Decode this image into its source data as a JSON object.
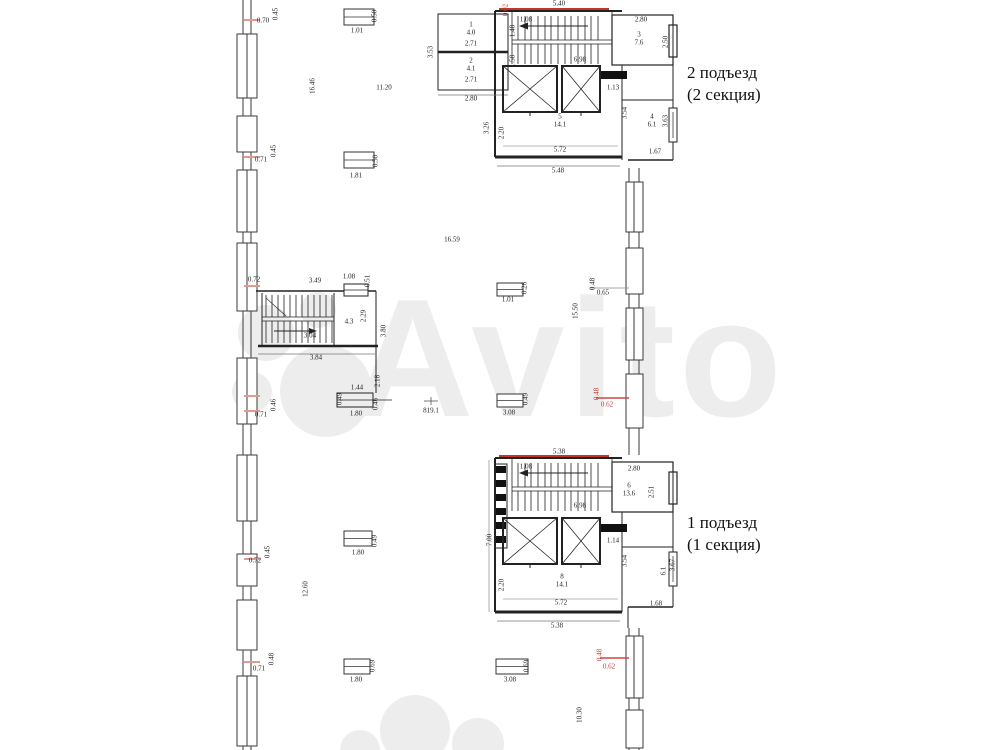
{
  "watermark": {
    "brand": "Avito"
  },
  "annotations": {
    "entrance2_line1": "2 подъезд",
    "entrance2_line2": "(2 секция)",
    "entrance1_line1": "1 подъезд",
    "entrance1_line2": "(1 секция)"
  },
  "plan": {
    "type": "floor-plan",
    "units": "meters",
    "large_area_label": "819.1",
    "labels": [
      {
        "t": "0.70",
        "x": 263,
        "y": 21
      },
      {
        "t": "0.45",
        "x": 276,
        "y": 14,
        "r": -90
      },
      {
        "t": "1.01",
        "x": 357,
        "y": 31
      },
      {
        "t": "0.50",
        "x": 375,
        "y": 16,
        "r": -90
      },
      {
        "t": "16.46",
        "x": 313,
        "y": 86,
        "r": -90
      },
      {
        "t": "11.20",
        "x": 384,
        "y": 88
      },
      {
        "t": "0.71",
        "x": 261,
        "y": 160
      },
      {
        "t": "0.45",
        "x": 274,
        "y": 151,
        "r": -90
      },
      {
        "t": "1.81",
        "x": 356,
        "y": 176
      },
      {
        "t": "0.50",
        "x": 376,
        "y": 161,
        "r": -90
      },
      {
        "t": "5.40",
        "x": 559,
        "y": 4
      },
      {
        "t": "0.02",
        "x": 506,
        "y": 10,
        "r": -90,
        "c": "red"
      },
      {
        "t": "1",
        "x": 471,
        "y": 25
      },
      {
        "t": "4.0",
        "x": 471,
        "y": 33
      },
      {
        "t": "2.71",
        "x": 471,
        "y": 44
      },
      {
        "t": "3.53",
        "x": 431,
        "y": 52,
        "r": -90
      },
      {
        "t": "1.48",
        "x": 513,
        "y": 31,
        "r": -90
      },
      {
        "t": "2",
        "x": 471,
        "y": 61
      },
      {
        "t": "4.1",
        "x": 471,
        "y": 69
      },
      {
        "t": "2.71",
        "x": 471,
        "y": 80
      },
      {
        "t": "1.58",
        "x": 513,
        "y": 61,
        "r": -90
      },
      {
        "t": "2.80",
        "x": 471,
        "y": 99
      },
      {
        "t": "1.08",
        "x": 526,
        "y": 20
      },
      {
        "t": "6.98",
        "x": 580,
        "y": 60
      },
      {
        "t": "2.80",
        "x": 641,
        "y": 20
      },
      {
        "t": "3",
        "x": 639,
        "y": 35
      },
      {
        "t": "7.6",
        "x": 639,
        "y": 43
      },
      {
        "t": "2.50",
        "x": 666,
        "y": 42,
        "r": -90
      },
      {
        "t": "1.13",
        "x": 613,
        "y": 88
      },
      {
        "t": "3.26",
        "x": 487,
        "y": 128,
        "r": -90
      },
      {
        "t": "2.20",
        "x": 502,
        "y": 133,
        "r": -90
      },
      {
        "t": "5",
        "x": 560,
        "y": 117
      },
      {
        "t": "14.1",
        "x": 560,
        "y": 125
      },
      {
        "t": "5.72",
        "x": 560,
        "y": 150
      },
      {
        "t": "3.54",
        "x": 625,
        "y": 113,
        "r": -90
      },
      {
        "t": "4",
        "x": 652,
        "y": 117
      },
      {
        "t": "6.1",
        "x": 652,
        "y": 125
      },
      {
        "t": "3.63",
        "x": 666,
        "y": 121,
        "r": -90
      },
      {
        "t": "1.67",
        "x": 655,
        "y": 152
      },
      {
        "t": "5.48",
        "x": 558,
        "y": 171
      },
      {
        "t": "16.59",
        "x": 452,
        "y": 240
      },
      {
        "t": "1.01",
        "x": 508,
        "y": 300
      },
      {
        "t": "0.26",
        "x": 525,
        "y": 288,
        "r": -90
      },
      {
        "t": "0.48",
        "x": 593,
        "y": 284,
        "r": -90
      },
      {
        "t": "0.65",
        "x": 603,
        "y": 293
      },
      {
        "t": "15.50",
        "x": 576,
        "y": 311,
        "r": -90
      },
      {
        "t": "0.72",
        "x": 254,
        "y": 280
      },
      {
        "t": "3.49",
        "x": 315,
        "y": 281
      },
      {
        "t": "1.08",
        "x": 349,
        "y": 277
      },
      {
        "t": "0.51",
        "x": 368,
        "y": 281,
        "r": -90
      },
      {
        "t": "4.3",
        "x": 349,
        "y": 322
      },
      {
        "t": "2.29",
        "x": 364,
        "y": 316,
        "r": -90
      },
      {
        "t": "3.04",
        "x": 310,
        "y": 336
      },
      {
        "t": "3.84",
        "x": 316,
        "y": 358
      },
      {
        "t": "3.80",
        "x": 384,
        "y": 331,
        "r": -90
      },
      {
        "t": "2.18",
        "x": 378,
        "y": 381,
        "r": -90
      },
      {
        "t": "1.44",
        "x": 357,
        "y": 388
      },
      {
        "t": "0.49",
        "x": 340,
        "y": 399,
        "r": -90
      },
      {
        "t": "1.80",
        "x": 356,
        "y": 414
      },
      {
        "t": "0.46",
        "x": 376,
        "y": 404,
        "r": -90
      },
      {
        "t": "0.71",
        "x": 261,
        "y": 415
      },
      {
        "t": "0.46",
        "x": 274,
        "y": 405,
        "r": -90
      },
      {
        "t": "819.1",
        "x": 431,
        "y": 411
      },
      {
        "t": "3.08",
        "x": 509,
        "y": 413
      },
      {
        "t": "0.49",
        "x": 526,
        "y": 399,
        "r": -90
      },
      {
        "t": "0.48",
        "x": 597,
        "y": 394,
        "r": -90,
        "c": "red"
      },
      {
        "t": "0.62",
        "x": 607,
        "y": 405,
        "c": "red"
      },
      {
        "t": "0.72",
        "x": 255,
        "y": 561
      },
      {
        "t": "0.45",
        "x": 268,
        "y": 552,
        "r": -90
      },
      {
        "t": "12.60",
        "x": 306,
        "y": 589,
        "r": -90
      },
      {
        "t": "1.80",
        "x": 358,
        "y": 553
      },
      {
        "t": "0.49",
        "x": 375,
        "y": 541,
        "r": -90
      },
      {
        "t": "0.71",
        "x": 259,
        "y": 669
      },
      {
        "t": "0.48",
        "x": 272,
        "y": 659,
        "r": -90
      },
      {
        "t": "1.80",
        "x": 356,
        "y": 680
      },
      {
        "t": "0.69",
        "x": 373,
        "y": 666,
        "r": -90
      },
      {
        "t": "5.38",
        "x": 559,
        "y": 452
      },
      {
        "t": "1.08",
        "x": 526,
        "y": 467
      },
      {
        "t": "6.98",
        "x": 580,
        "y": 506
      },
      {
        "t": "2.80",
        "x": 634,
        "y": 469
      },
      {
        "t": "6",
        "x": 629,
        "y": 486
      },
      {
        "t": "13.6",
        "x": 629,
        "y": 494
      },
      {
        "t": "2.51",
        "x": 652,
        "y": 492,
        "r": -90
      },
      {
        "t": "7.00",
        "x": 490,
        "y": 540,
        "r": -90
      },
      {
        "t": "1.14",
        "x": 613,
        "y": 541
      },
      {
        "t": "3.54",
        "x": 625,
        "y": 561,
        "r": -90
      },
      {
        "t": "6.1",
        "x": 664,
        "y": 571,
        "r": -90
      },
      {
        "t": "3.67",
        "x": 673,
        "y": 565,
        "r": -90
      },
      {
        "t": "2.20",
        "x": 502,
        "y": 585,
        "r": -90
      },
      {
        "t": "8",
        "x": 562,
        "y": 577
      },
      {
        "t": "14.1",
        "x": 562,
        "y": 585
      },
      {
        "t": "5.72",
        "x": 561,
        "y": 603
      },
      {
        "t": "1.68",
        "x": 656,
        "y": 604
      },
      {
        "t": "5.38",
        "x": 557,
        "y": 626
      },
      {
        "t": "3.08",
        "x": 510,
        "y": 680
      },
      {
        "t": "0.69",
        "x": 527,
        "y": 666,
        "r": -90
      },
      {
        "t": "0.48",
        "x": 600,
        "y": 655,
        "r": -90,
        "c": "red"
      },
      {
        "t": "0.62",
        "x": 609,
        "y": 667,
        "c": "red"
      },
      {
        "t": "10.30",
        "x": 580,
        "y": 715,
        "r": -90
      }
    ]
  }
}
